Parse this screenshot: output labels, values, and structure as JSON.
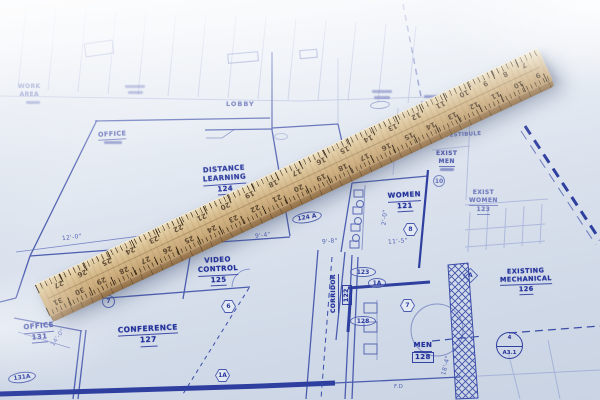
{
  "scene": {
    "type": "photograph",
    "description": "Wooden drafting ruler lying diagonally across a blue architectural floor-plan blueprint"
  },
  "blueprint": {
    "ink_color": "#2e3f9f",
    "paper_color": "#dce3ee",
    "rooms": {
      "work_area": {
        "l1": "WORK",
        "l2": "AREA"
      },
      "office_upper": {
        "l1": "OFFICE"
      },
      "lobby": {
        "l1": "LOBBY"
      },
      "distance_learning": {
        "l1": "DISTANCE",
        "l2": "LEARNING",
        "num": "124"
      },
      "video_control": {
        "l1": "VIDEO",
        "l2": "CONTROL",
        "num": "125"
      },
      "conference": {
        "l1": "CONFERENCE",
        "num": "127"
      },
      "corridor": {
        "l1": "CORRIDOR",
        "num": "122"
      },
      "women": {
        "l1": "WOMEN",
        "num": "121"
      },
      "exist_men": {
        "l1": "EXIST",
        "l2": "MEN"
      },
      "exist_women": {
        "l1": "EXIST",
        "l2": "WOMEN",
        "num": "123"
      },
      "existing_mechanical": {
        "l1": "EXISTING",
        "l2": "MECHANICAL",
        "num": "126"
      },
      "men": {
        "l1": "MEN",
        "num": "128"
      },
      "vestibule": {
        "l1": "VESTIBULE"
      },
      "office_lower": {
        "l1": "OFFICE",
        "num": "131"
      }
    },
    "door_tags": {
      "t123": "123",
      "t128": "128",
      "t124a": "124 A",
      "t131a": "131A",
      "t1a_oval": "1A",
      "t10": "10"
    },
    "keynotes": {
      "hex7": "7",
      "hex8": "8",
      "hex6": "6",
      "hex1a": "1A",
      "circ7": "7",
      "diamond_a": "A"
    },
    "section_marker": {
      "detail": "4",
      "sheet": "A3.1"
    },
    "dimensions": {
      "d12_0": "12'-0\"",
      "d9_4": "9'-4\"",
      "d9_8": "9'-8\"",
      "d11_5": "11'-5\"",
      "d2_0": "2'-0\"",
      "d18_4": "18'-4\"",
      "d14_0": "14'-0\"",
      "fd": "F.D"
    }
  },
  "ruler": {
    "material": "wood",
    "wood_color": "#d2b388",
    "scale_top": [
      27,
      26,
      25,
      24,
      23,
      22,
      21,
      20,
      19,
      18,
      17,
      16,
      15,
      14,
      13,
      12,
      11,
      10,
      9,
      8,
      7
    ],
    "scale_bottom": [
      31,
      30,
      29,
      28,
      27,
      26,
      25,
      24,
      23,
      22,
      21,
      20,
      19,
      18,
      17,
      16,
      15,
      14,
      13,
      12,
      11,
      10,
      9
    ]
  }
}
